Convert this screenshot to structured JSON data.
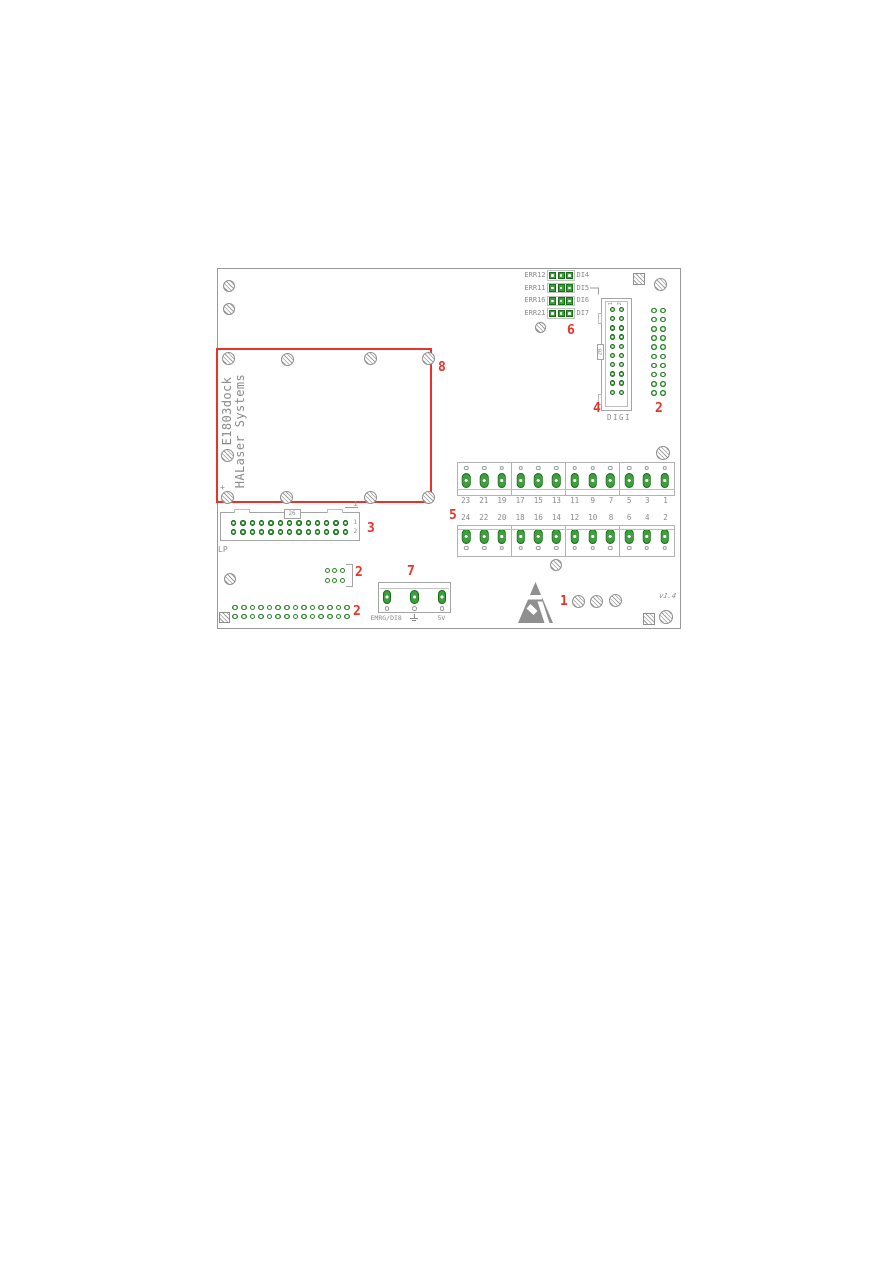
{
  "colors": {
    "pad_green": "#3f9f3f",
    "pad_green_dark": "#156f15",
    "silkscreen_gray": "#8a8a8a",
    "outline_gray": "#a4a4a4",
    "annotation_red": "#e8332a"
  },
  "board": {
    "version": "v1.4"
  },
  "module": {
    "title": "E1803dock",
    "subtitle": "HALaser Systems",
    "polarity_mark": "+",
    "callout": "8"
  },
  "jumpers": {
    "callout": "6",
    "pads_per_row": 3,
    "rows": [
      {
        "left": "ERR12",
        "right": "DI4"
      },
      {
        "left": "ERR11",
        "right": "DI5"
      },
      {
        "left": "ERR16",
        "right": "DI6"
      },
      {
        "left": "ERR21",
        "right": "DI7"
      }
    ]
  },
  "digi": {
    "callout": "4",
    "label": "DIGI",
    "pin_count_badge": "20",
    "column_labels": [
      "1",
      "2"
    ],
    "rows": 10,
    "cols": 2
  },
  "right_grid": {
    "callout": "2",
    "rows": 10,
    "cols": 2
  },
  "lp": {
    "callout": "3",
    "label": "LP",
    "pin_count_badge": "26",
    "pin1_label": "1",
    "row_labels": [
      "1",
      "2"
    ],
    "rows": 2,
    "cols": 13
  },
  "terminal": {
    "callout": "5",
    "positions": 12,
    "groups": 4,
    "top_row_numbers": [
      "23",
      "21",
      "19",
      "17",
      "15",
      "13",
      "11",
      "9",
      "7",
      "5",
      "3",
      "1"
    ],
    "bottom_row_numbers": [
      "24",
      "22",
      "20",
      "18",
      "16",
      "14",
      "12",
      "10",
      "8",
      "6",
      "4",
      "2"
    ]
  },
  "aux_header": {
    "callout": "2",
    "rows": 2,
    "cols": 3
  },
  "bottom_header": {
    "callout": "2",
    "rows": 2,
    "cols": 14
  },
  "emrg": {
    "callout": "7",
    "left_label": "EMRG/DI8",
    "right_label": "5V",
    "pins": 3
  },
  "esd": {
    "callout": "1"
  },
  "icons": {
    "esd": "esd-warning-triangle",
    "ground": "earth-ground-symbol",
    "hatched_circle": "mounting-hole",
    "hatched_square": "fiducial-pad"
  }
}
